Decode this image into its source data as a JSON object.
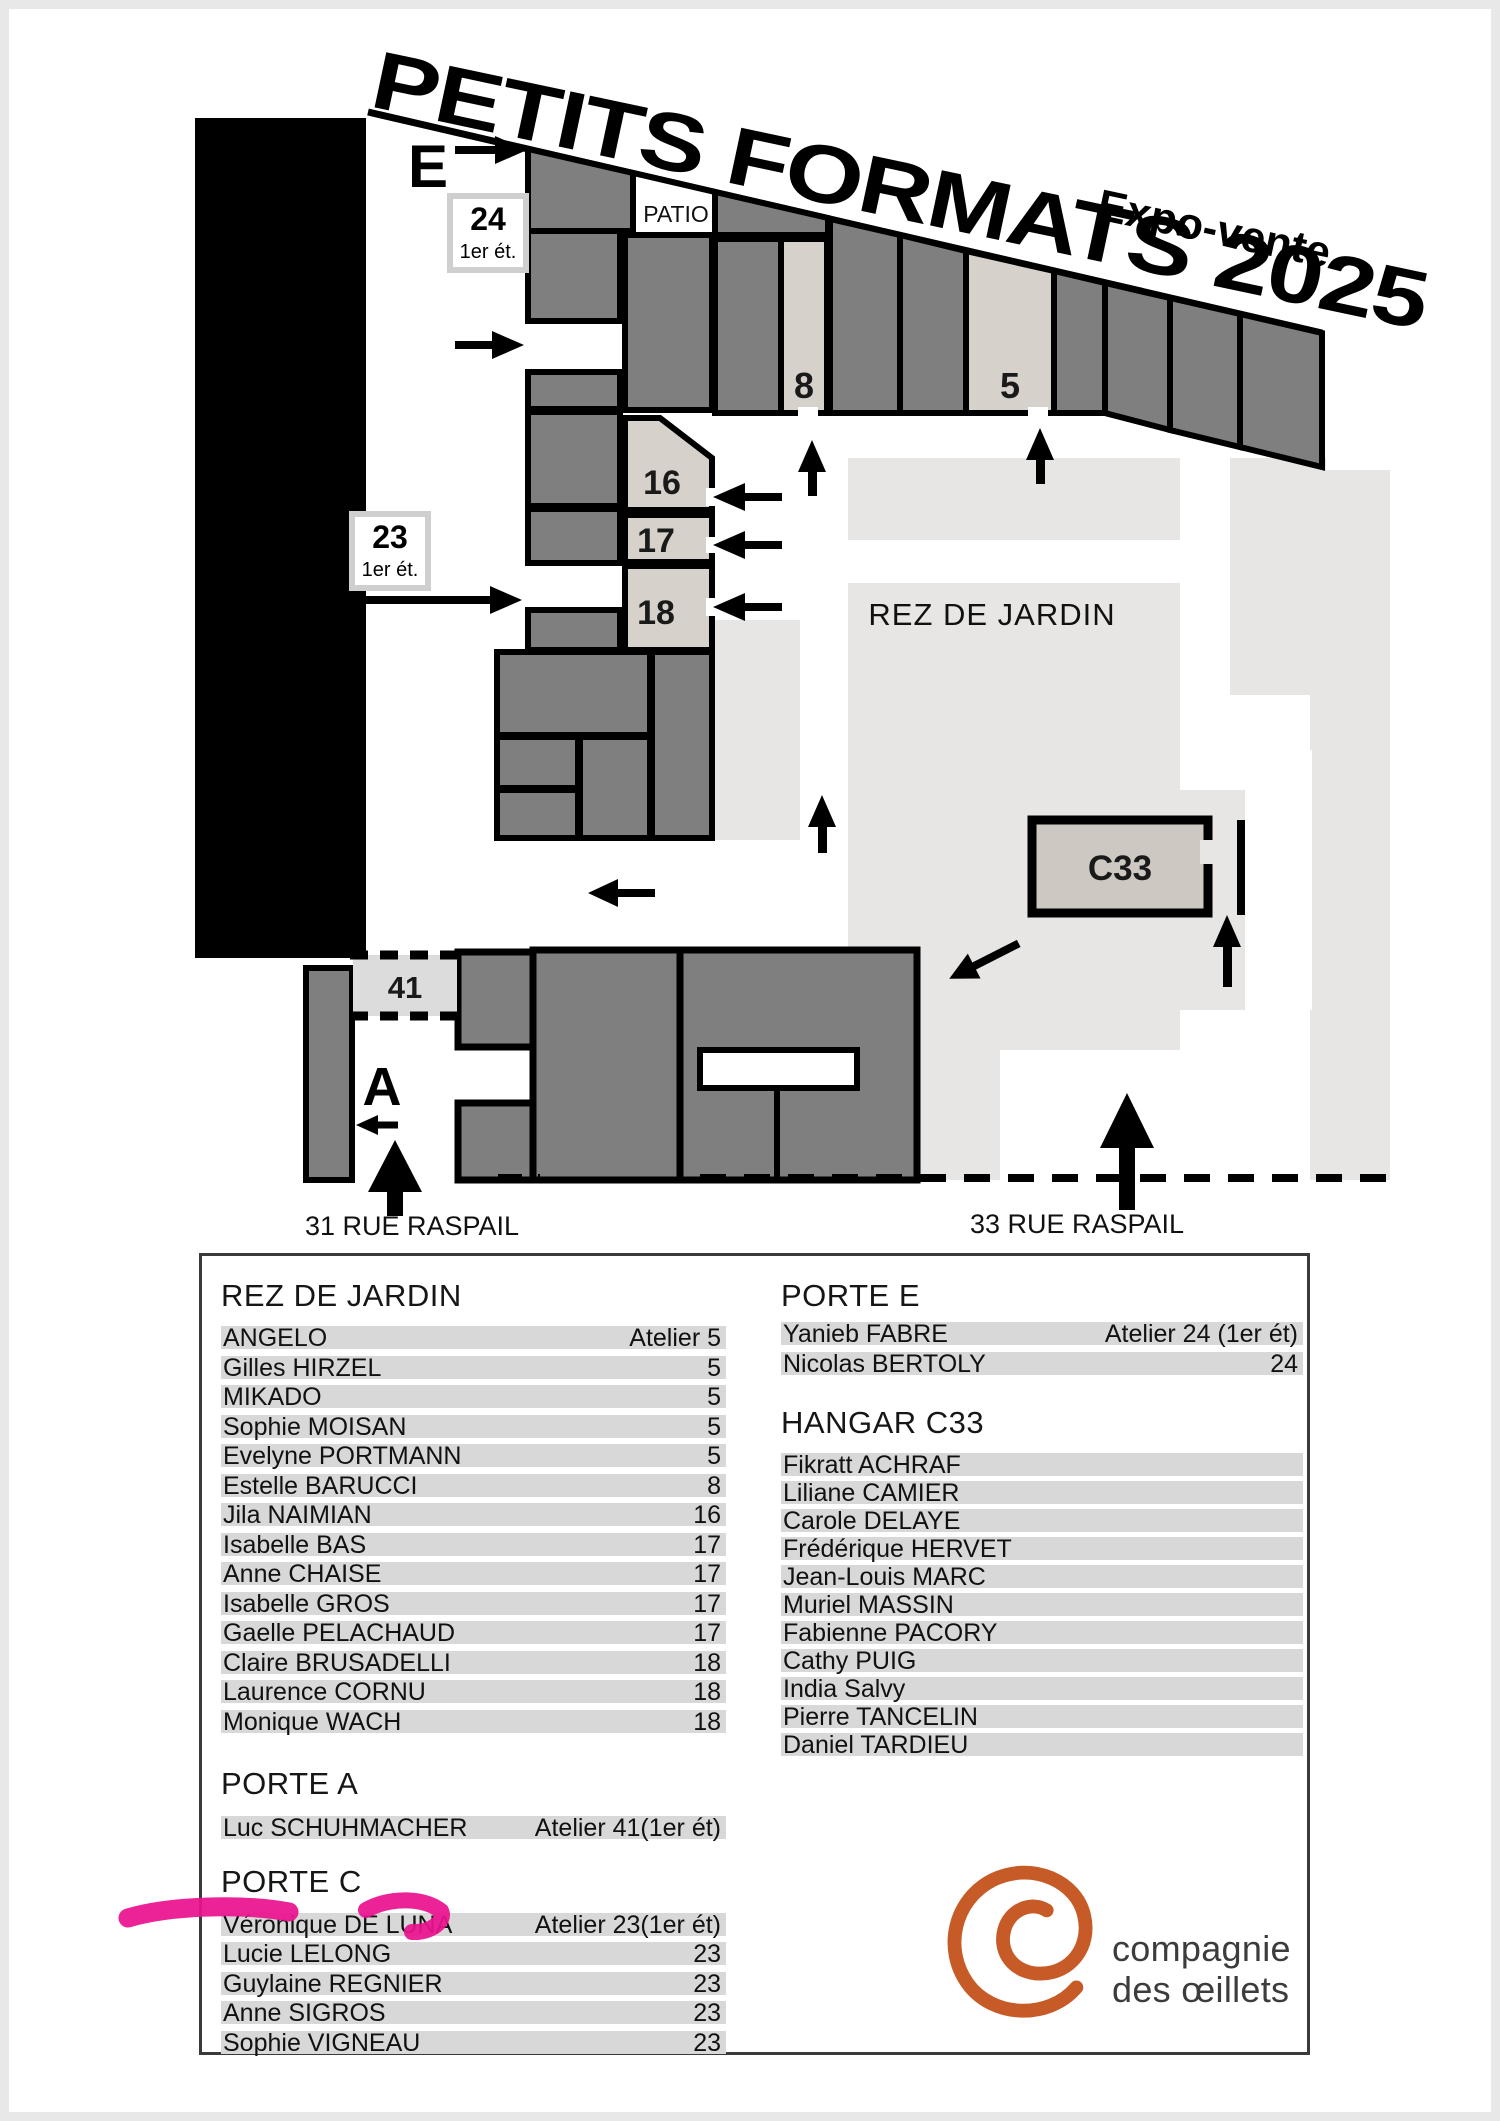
{
  "header": {
    "title": "PETITS FORMATS 2025",
    "subtitle": "Expo-vente"
  },
  "map": {
    "patio_label": "PATIO",
    "courtyard_label": "REZ DE JARDIN",
    "hangar_label": "C33",
    "street_31": "31 RUE RASPAIL",
    "street_33": "33 RUE RASPAIL",
    "entrance_e": {
      "letter": "E",
      "box_number": "24",
      "box_floor": "1er ét."
    },
    "entrance_c": {
      "letter": "C",
      "box_number": "23",
      "box_floor": "1er ét."
    },
    "entrance_a": {
      "letter": "A"
    },
    "room_8": "8",
    "room_5": "5",
    "room_16": "16",
    "room_17": "17",
    "room_18": "18",
    "room_41": "41"
  },
  "lists": {
    "rez": {
      "heading": "REZ DE JARDIN",
      "rows": [
        {
          "name": "ANGELO",
          "value": "Atelier 5"
        },
        {
          "name": "Gilles HIRZEL",
          "value": "5"
        },
        {
          "name": "MIKADO",
          "value": "5"
        },
        {
          "name": "Sophie MOISAN",
          "value": "5"
        },
        {
          "name": "Evelyne PORTMANN",
          "value": "5"
        },
        {
          "name": "Estelle BARUCCI",
          "value": "8"
        },
        {
          "name": "Jila NAIMIAN",
          "value": "16"
        },
        {
          "name": "Isabelle BAS",
          "value": "17"
        },
        {
          "name": "Anne CHAISE",
          "value": "17"
        },
        {
          "name": "Isabelle GROS",
          "value": "17"
        },
        {
          "name": "Gaelle PELACHAUD",
          "value": "17"
        },
        {
          "name": "Claire BRUSADELLI",
          "value": "18"
        },
        {
          "name": "Laurence CORNU",
          "value": "18"
        },
        {
          "name": "Monique WACH",
          "value": "18"
        }
      ]
    },
    "porte_a": {
      "heading": "PORTE A",
      "rows": [
        {
          "name": "Luc SCHUHMACHER",
          "value": "Atelier 41(1er ét)"
        }
      ]
    },
    "porte_c": {
      "heading": "PORTE C",
      "rows": [
        {
          "name": "Véronique DE LUNA",
          "value": "Atelier 23(1er ét)"
        },
        {
          "name": "Lucie LELONG",
          "value": "23"
        },
        {
          "name": "Guylaine REGNIER",
          "value": "23"
        },
        {
          "name": "Anne SIGROS",
          "value": "23"
        },
        {
          "name": "Sophie VIGNEAU",
          "value": "23"
        }
      ]
    },
    "porte_e": {
      "heading": "PORTE E",
      "rows": [
        {
          "name": "Yanieb FABRE",
          "value": "Atelier 24 (1er ét)"
        },
        {
          "name": "Nicolas BERTOLY",
          "value": "24"
        }
      ]
    },
    "hangar": {
      "heading": "HANGAR C33",
      "rows": [
        {
          "name": "Fikratt ACHRAF",
          "value": ""
        },
        {
          "name": "Liliane CAMIER",
          "value": ""
        },
        {
          "name": "Carole DELAYE",
          "value": ""
        },
        {
          "name": "Frédérique HERVET",
          "value": ""
        },
        {
          "name": "Jean-Louis MARC",
          "value": ""
        },
        {
          "name": "Muriel MASSIN",
          "value": ""
        },
        {
          "name": "Fabienne PACORY",
          "value": ""
        },
        {
          "name": "Cathy PUIG",
          "value": ""
        },
        {
          "name": "India Salvy",
          "value": ""
        },
        {
          "name": "Pierre TANCELIN",
          "value": ""
        },
        {
          "name": "Daniel TARDIEU",
          "value": ""
        }
      ]
    }
  },
  "logo": {
    "line1": "compagnie",
    "line2": "des œillets"
  },
  "colors": {
    "room_dark": "#7f7f7f",
    "room_light": "#d6d1ca",
    "courtyard": "#e7e6e5",
    "wall": "#000000",
    "highlight_marker": "#e9128e",
    "logo_orange": "#c75b28"
  }
}
